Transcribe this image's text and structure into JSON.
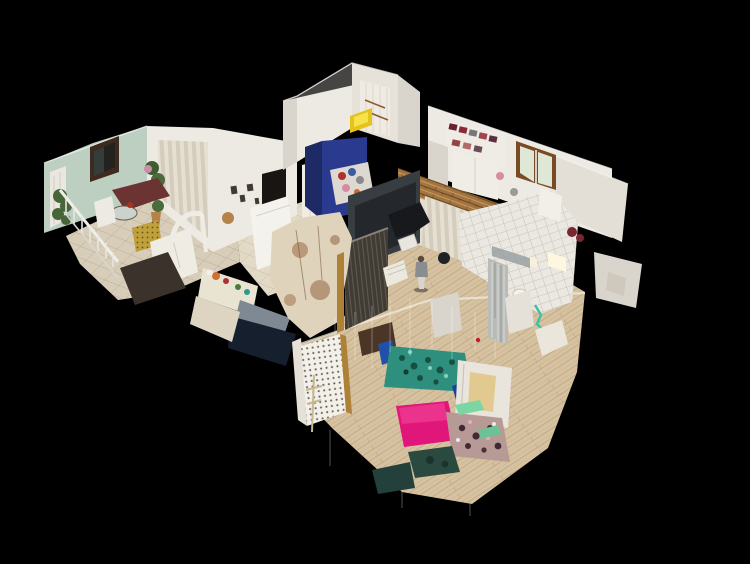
{
  "scene": {
    "view_type": "dollhouse-3d-scan",
    "background": "#000000",
    "rooms": [
      "living-dining-room",
      "hallway",
      "kitchen",
      "top-white-room",
      "blue-bedroom",
      "walk-in-closet",
      "studio-room",
      "bathroom",
      "lower-bedroom"
    ],
    "figures": [
      "standing-person"
    ]
  },
  "palette": {
    "background": "#000000",
    "wall_white": "#eceae3",
    "wall_white_dim": "#d9d5cd",
    "wall_mint": "#bccfc0",
    "wall_navy_bright": "#2a3a8f",
    "wall_navy_dark": "#1d2a66",
    "wall_slate": "#383d42",
    "door_corrugate": "#403b34",
    "brick_base": "#a3743e",
    "curtain_light": "#e6e0d2",
    "tile_floor": "#d8cdb9",
    "tile_floor_light": "#e2dac7",
    "wood_floor": "#d6c2a0",
    "bath_tile": "#ebe8e2",
    "mesh_cream": "#e0d3bc",
    "kitchen_navy": "#161f2d",
    "counter_grey": "#7e8994",
    "bed_teal": "#2f8f7e",
    "bed_blue": "#2050a8",
    "bed_blue_deep": "#1d3f97",
    "bed_pink": "#e0167a",
    "bed_floral": "#b79a96",
    "bench_green": "#7cd6a4",
    "accent_yellow": "#e6c31a",
    "plant_green": "#46663a",
    "sofa_maroon": "#6b3331",
    "ottoman_gold": "#c0a03a",
    "cabinet_cream": "#e9e3d2",
    "lattice_white": "#f3f0e9",
    "window_frame_brown": "#7a4a24",
    "window_glass_green": "#dfe7d6"
  }
}
